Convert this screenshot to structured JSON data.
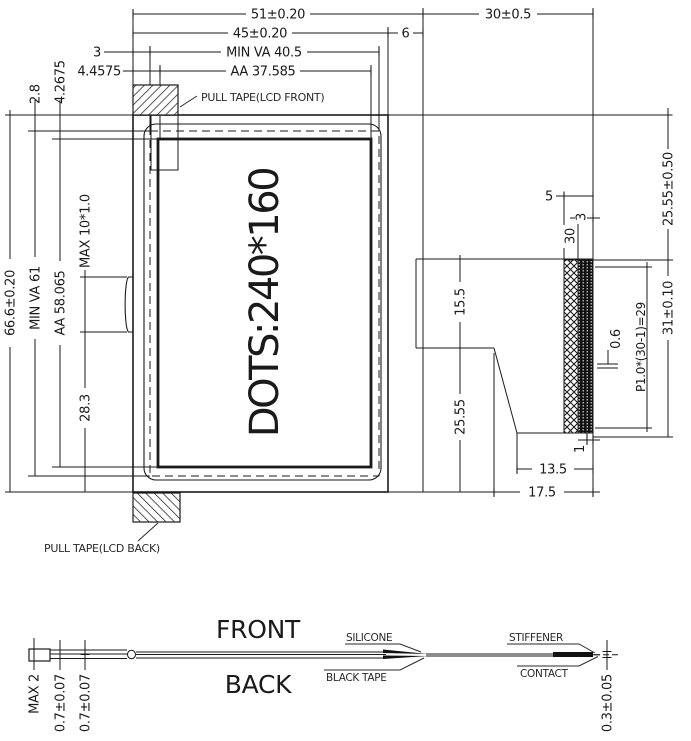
{
  "front_view": {
    "display_text": "DOTS:240*160",
    "pull_tape_front": "PULL TAPE(LCD FRONT)",
    "pull_tape_back": "PULL TAPE(LCD BACK)"
  },
  "dims_top": {
    "total_width": "51±0.20",
    "glass_width": "45±0.20",
    "min_va_width": "MIN VA 40.5",
    "aa_width": "AA 37.585",
    "va_left_offset": "3",
    "aa_left_offset": "4.4575",
    "fold_width": "6",
    "fpc_length": "30±0.5"
  },
  "dims_left": {
    "total_height": "66.6±0.20",
    "min_va_height": "MIN VA 61",
    "aa_height": "AA 58.065",
    "va_top_offset": "2.8",
    "aa_top_offset": "4.2675",
    "tab_size": "MAX 10*1.0",
    "tab_bottom_offset": "28.3"
  },
  "dims_side": {
    "contact_top_offset": "25.55±0.50",
    "stiffener_len": "5",
    "contact_len": "3",
    "pin_count": "30",
    "fpc_top": "15.5",
    "fpc_bottom": "25.55",
    "contact_pitch": "P1.0*(30-1)=29",
    "contact_width": "0.6",
    "connector_height": "31±0.10",
    "tail_tip": "1",
    "tail_13_5": "13.5",
    "tail_17_5": "17.5"
  },
  "profile": {
    "front_label": "FRONT",
    "back_label": "BACK",
    "silicone": "SILICONE",
    "black_tape": "BLACK TAPE",
    "stiffener": "STIFFENER",
    "contact": "CONTACT",
    "max_thickness": "MAX 2",
    "polarizer_top": "0.7±0.07",
    "polarizer_bottom": "0.7±0.07",
    "fpc_thickness": "0.3±0.05"
  },
  "colors": {
    "line": "#1a1a1a",
    "background": "#ffffff"
  }
}
